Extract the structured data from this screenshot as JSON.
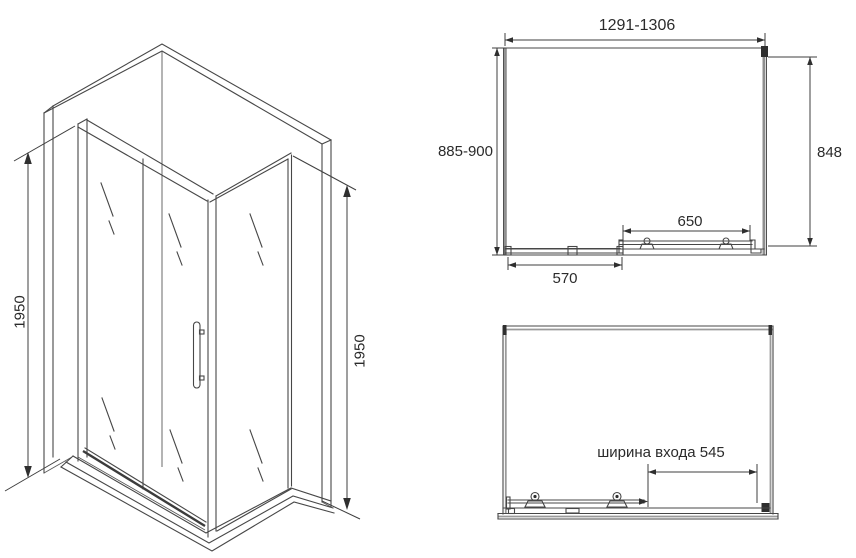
{
  "drawing": {
    "type": "shower-enclosure-technical-drawing",
    "colors": {
      "background": "#ffffff",
      "line": "#474747",
      "line_gray": "#8f8f8f",
      "detail_fill": "#2f2f2f",
      "text": "#2b2b2b"
    },
    "isometric_view": {
      "height_left_label": "1950",
      "height_right_label": "1950"
    },
    "top_view": {
      "width_label": "1291-1306",
      "depth_label": "885-900",
      "right_depth_label": "848",
      "door_rail_label": "650",
      "fixed_panel_label": "570"
    },
    "front_view": {
      "entrance_width_label": "ширина входа 545"
    }
  }
}
